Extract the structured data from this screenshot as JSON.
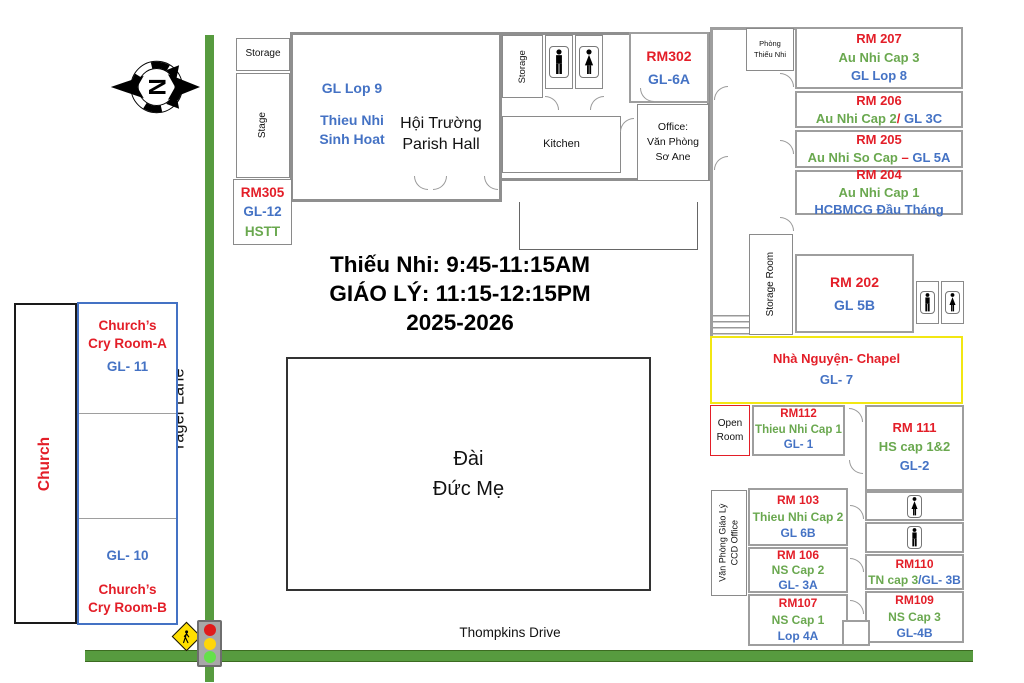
{
  "colors": {
    "room_red": "#e31e28",
    "gl_blue": "#4472c4",
    "cap_green": "#6aa84f",
    "road_green": "#579b3f",
    "wall_gray": "#9e9e9e",
    "chapel_yellow": "#f2e713",
    "annex_blue": "#4472c4",
    "open_room_red": "#e31e28"
  },
  "compass": {
    "label": "N"
  },
  "schedule": {
    "l1": "Thiếu Nhi: 9:45-11:15AM",
    "l2": "GIÁO LÝ: 11:15-12:15PM",
    "l3": "2025-2026"
  },
  "shrine": {
    "l1": "Đài",
    "l2": "Đức Mẹ"
  },
  "roads": {
    "vertical": "Yager Lane",
    "horizontal": "Thompkins Drive"
  },
  "church": {
    "name": "Church",
    "cry_a1": "Church’s",
    "cry_a2": "Cry Room-A",
    "gl_a": "GL- 11",
    "gl_b": "GL- 10",
    "cry_b1": "Church’s",
    "cry_b2": "Cry Room-B"
  },
  "main": {
    "storage_top": "Storage",
    "stage": "Stage",
    "rm305": {
      "rm": "RM305",
      "gl": "GL-12",
      "extra": "HSTT"
    },
    "hall": {
      "gl": "GL Lop 9",
      "g1": "Thieu Nhi",
      "g2": "Sinh Hoat",
      "n1": "Hội Trường",
      "n2": "Parish Hall"
    },
    "storage_side": "Storage",
    "kitchen": "Kitchen",
    "office": {
      "l1": "Office:",
      "l2": "Văn Phòng",
      "l3": "Sơ Ane"
    },
    "rm302": {
      "rm": "RM302",
      "gl": "GL-6A"
    }
  },
  "wing": {
    "phong": {
      "l1": "Phòng",
      "l2": "Thiếu Nhi"
    },
    "rm207": {
      "rm": "RM 207",
      "g": "Au Nhi Cap 3",
      "gl": "GL Lop 8"
    },
    "rm206": {
      "rm": "RM 206",
      "g": "Au Nhi Cap 2",
      "sep": "/",
      "gl": " GL 3C"
    },
    "rm205": {
      "rm": "RM 205",
      "g": "Au Nhi So Cap",
      "sep": " – ",
      "gl": "GL 5A"
    },
    "rm204": {
      "rm": "RM 204",
      "g": "Au Nhi Cap 1",
      "gl": "HCBMCG Đầu Tháng"
    },
    "storage_room": "Storage Room",
    "rm202": {
      "rm": "RM 202",
      "gl": "GL 5B"
    },
    "chapel": {
      "name": "Nhà Nguyện- Chapel",
      "gl": "GL- 7"
    },
    "open_room": {
      "l1": "Open",
      "l2": "Room"
    },
    "rm112": {
      "rm": "RM112",
      "g": "Thieu Nhi Cap 1",
      "gl": "GL- 1"
    },
    "rm111": {
      "rm": "RM 111",
      "g": "HS cap 1&2",
      "gl": "GL-2"
    },
    "vp": {
      "l1": "Văn Phòng Giáo Lý",
      "l2": "CCD Office"
    },
    "rm103": {
      "rm": "RM 103",
      "g": "Thieu Nhi Cap 2",
      "gl": "GL 6B"
    },
    "rm106": {
      "rm": "RM 106",
      "g": "NS Cap 2",
      "gl": "GL- 3A"
    },
    "rm107": {
      "rm": "RM107",
      "g": "NS Cap 1",
      "gl": "Lop 4A"
    },
    "rm110": {
      "rm": "RM110",
      "g": "TN cap 3",
      "gl": "/GL- 3B"
    },
    "rm109": {
      "rm": "RM109",
      "g": "NS Cap 3",
      "gl": "GL-4B"
    }
  }
}
